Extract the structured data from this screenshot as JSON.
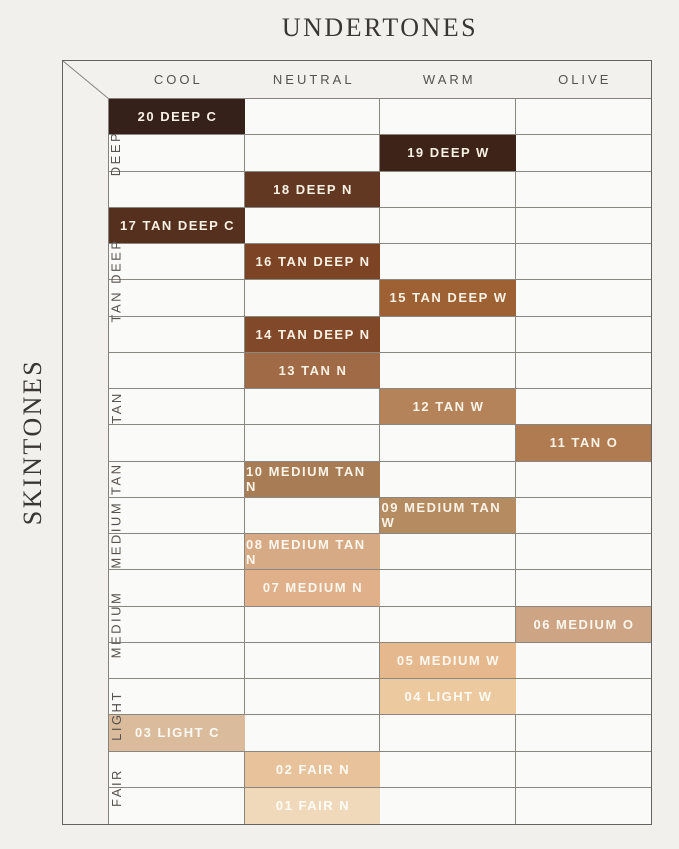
{
  "page": {
    "background": "#f2f0ed"
  },
  "chart_data": {
    "type": "heatmap",
    "title": "",
    "xlabel": "UNDERTONES",
    "ylabel": "SKINTONES",
    "legend": "none",
    "grid": true,
    "columns": [
      "COOL",
      "NEUTRAL",
      "WARM",
      "OLIVE"
    ],
    "row_groups": [
      {
        "label": "DEEP",
        "rows": 3
      },
      {
        "label": "TAN DEEP",
        "rows": 4
      },
      {
        "label": "TAN",
        "rows": 3
      },
      {
        "label": "MEDIUM TAN",
        "rows": 3
      },
      {
        "label": "MEDIUM",
        "rows": 3
      },
      {
        "label": "LIGHT",
        "rows": 2
      },
      {
        "label": "FAIR",
        "rows": 2
      }
    ],
    "rows": [
      {
        "shade": "20 DEEP C",
        "undertone": "COOL",
        "col_index": 0,
        "group": "DEEP",
        "color": "#35211a",
        "text_color": "#f9f1e3"
      },
      {
        "shade": "19 DEEP W",
        "undertone": "WARM",
        "col_index": 2,
        "group": "DEEP",
        "color": "#3e2318",
        "text_color": "#f9f1e3"
      },
      {
        "shade": "18 DEEP N",
        "undertone": "NEUTRAL",
        "col_index": 1,
        "group": "DEEP",
        "color": "#633823",
        "text_color": "#f9f1e3"
      },
      {
        "shade": "17 TAN DEEP C",
        "undertone": "COOL",
        "col_index": 0,
        "group": "TAN DEEP",
        "color": "#56301e",
        "text_color": "#f9f1e3"
      },
      {
        "shade": "16 TAN DEEP N",
        "undertone": "NEUTRAL",
        "col_index": 1,
        "group": "TAN DEEP",
        "color": "#7c4425",
        "text_color": "#f9f1e3"
      },
      {
        "shade": "15 TAN DEEP W",
        "undertone": "WARM",
        "col_index": 2,
        "group": "TAN DEEP",
        "color": "#9d6134",
        "text_color": "#f9f1e3"
      },
      {
        "shade": "14 TAN DEEP N",
        "undertone": "NEUTRAL",
        "col_index": 1,
        "group": "TAN DEEP",
        "color": "#82482a",
        "text_color": "#f9f1e3"
      },
      {
        "shade": "13 TAN N",
        "undertone": "NEUTRAL",
        "col_index": 1,
        "group": "TAN",
        "color": "#9f6a45",
        "text_color": "#f9f1e3"
      },
      {
        "shade": "12 TAN W",
        "undertone": "WARM",
        "col_index": 2,
        "group": "TAN",
        "color": "#b5835a",
        "text_color": "#faf3e8"
      },
      {
        "shade": "11 TAN O",
        "undertone": "OLIVE",
        "col_index": 3,
        "group": "TAN",
        "color": "#b07b50",
        "text_color": "#faf3e8"
      },
      {
        "shade": "10 MEDIUM TAN N",
        "undertone": "NEUTRAL",
        "col_index": 1,
        "group": "MEDIUM TAN",
        "color": "#a87d56",
        "text_color": "#faf3e8"
      },
      {
        "shade": "09 MEDIUM TAN W",
        "undertone": "WARM",
        "col_index": 2,
        "group": "MEDIUM TAN",
        "color": "#b58b61",
        "text_color": "#faf3e8"
      },
      {
        "shade": "08 MEDIUM TAN N",
        "undertone": "NEUTRAL",
        "col_index": 1,
        "group": "MEDIUM TAN",
        "color": "#d7aa86",
        "text_color": "#fcf7ee"
      },
      {
        "shade": "07 MEDIUM N",
        "undertone": "NEUTRAL",
        "col_index": 1,
        "group": "MEDIUM",
        "color": "#dfb08a",
        "text_color": "#fcf7ee"
      },
      {
        "shade": "06 MEDIUM O",
        "undertone": "OLIVE",
        "col_index": 3,
        "group": "MEDIUM",
        "color": "#cda484",
        "text_color": "#fcf7ee"
      },
      {
        "shade": "05 MEDIUM W",
        "undertone": "WARM",
        "col_index": 2,
        "group": "MEDIUM",
        "color": "#e5b88d",
        "text_color": "#fdf9f1"
      },
      {
        "shade": "04 LIGHT W",
        "undertone": "WARM",
        "col_index": 2,
        "group": "LIGHT",
        "color": "#edc9a0",
        "text_color": "#fdfaf3"
      },
      {
        "shade": "03 LIGHT C",
        "undertone": "COOL",
        "col_index": 0,
        "group": "LIGHT",
        "color": "#dabb9c",
        "text_color": "#fdfaf3"
      },
      {
        "shade": "02 FAIR N",
        "undertone": "NEUTRAL",
        "col_index": 1,
        "group": "FAIR",
        "color": "#e8c29a",
        "text_color": "#fdfaf3"
      },
      {
        "shade": "01 FAIR N",
        "undertone": "NEUTRAL",
        "col_index": 1,
        "group": "FAIR",
        "color": "#f0d9ba",
        "text_color": "#fefcf6"
      }
    ]
  }
}
